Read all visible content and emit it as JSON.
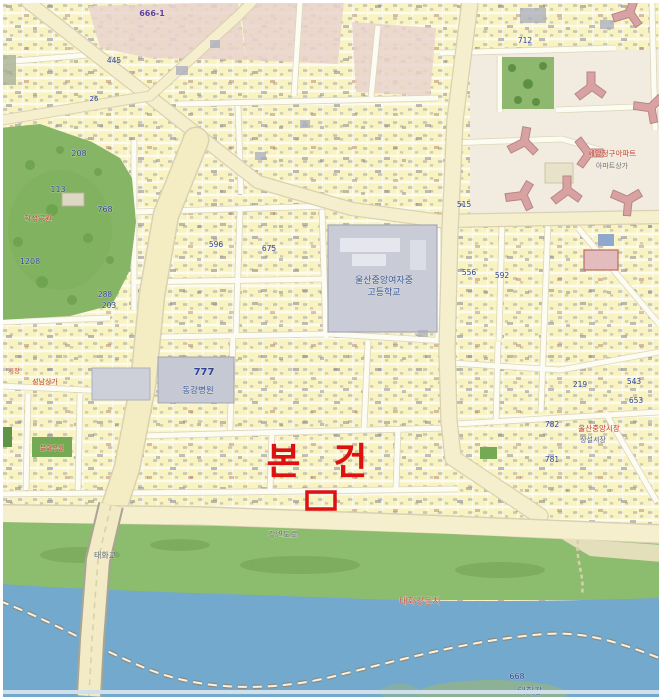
{
  "map": {
    "type": "cadastral-street-map",
    "subject": {
      "label": "본 건",
      "marker_shape": "red-outline-rectangle"
    },
    "colors": {
      "accent_red": "#dd1111",
      "parcel_yellow": "#f8f3c0",
      "road_cream": "#f6efcd",
      "road_white": "#fdfcf3",
      "park_green": "#86b565",
      "bank_green": "#8cbc6d",
      "river_blue": "#72a9cd",
      "apartment_pink": "#d9a2a2",
      "school_gray": "#c9ccd6",
      "commercial_pink": "#e9d4ce"
    },
    "labels": [
      {
        "t": "666-1",
        "x": 152,
        "y": 16,
        "c": "#5b3f9e",
        "s": 8,
        "b": true
      },
      {
        "t": "445",
        "x": 114,
        "y": 63,
        "c": "#2f4396",
        "s": 7.5
      },
      {
        "t": "26",
        "x": 94,
        "y": 101,
        "c": "#2f4396",
        "s": 7
      },
      {
        "t": "712",
        "x": 525,
        "y": 43,
        "c": "#2f4396",
        "s": 7.5
      },
      {
        "t": "208",
        "x": 79,
        "y": 156,
        "c": "#2f4396",
        "s": 8
      },
      {
        "t": "113",
        "x": 58,
        "y": 192,
        "c": "#2f4396",
        "s": 8
      },
      {
        "t": "768",
        "x": 105,
        "y": 212,
        "c": "#2f4396",
        "s": 8
      },
      {
        "t": "학성공원",
        "x": 38,
        "y": 221,
        "c": "#c23b32",
        "s": 7.5
      },
      {
        "t": "1208",
        "x": 30,
        "y": 264,
        "c": "#2f4396",
        "s": 8
      },
      {
        "t": "288",
        "x": 105,
        "y": 297,
        "c": "#2f4396",
        "s": 7.5
      },
      {
        "t": "203",
        "x": 109,
        "y": 308,
        "c": "#2f4396",
        "s": 7.5
      },
      {
        "t": "울산중앙여자중",
        "x": 384,
        "y": 283,
        "c": "#33549e",
        "s": 9
      },
      {
        "t": "고등학교",
        "x": 384,
        "y": 295,
        "c": "#33549e",
        "s": 9
      },
      {
        "t": "세양청구아파트",
        "x": 612,
        "y": 156,
        "c": "#c23b32",
        "s": 7.5
      },
      {
        "t": "아파트상가",
        "x": 612,
        "y": 168,
        "c": "#6b6f78",
        "s": 7
      },
      {
        "t": "596",
        "x": 216,
        "y": 247,
        "c": "#2f4396",
        "s": 7.5
      },
      {
        "t": "675",
        "x": 269,
        "y": 251,
        "c": "#2f4396",
        "s": 7.5
      },
      {
        "t": "515",
        "x": 464,
        "y": 207,
        "c": "#2f4396",
        "s": 7.5
      },
      {
        "t": "556",
        "x": 469,
        "y": 275,
        "c": "#2f4396",
        "s": 7.5
      },
      {
        "t": "592",
        "x": 502,
        "y": 278,
        "c": "#2f4396",
        "s": 7.5
      },
      {
        "t": "777",
        "x": 204,
        "y": 375,
        "c": "#2f4396",
        "s": 10,
        "b": true
      },
      {
        "t": "동강병원",
        "x": 198,
        "y": 393,
        "c": "#33549e",
        "s": 8.5
      },
      {
        "t": "성남상가",
        "x": 45,
        "y": 384,
        "c": "#c23b32",
        "s": 7
      },
      {
        "t": "시장",
        "x": 14,
        "y": 373,
        "c": "#c23b32",
        "s": 6.5
      },
      {
        "t": "219",
        "x": 580,
        "y": 387,
        "c": "#2f4396",
        "s": 7.5
      },
      {
        "t": "543",
        "x": 634,
        "y": 384,
        "c": "#2f4396",
        "s": 7.5
      },
      {
        "t": "653",
        "x": 636,
        "y": 403,
        "c": "#2f4396",
        "s": 7.5
      },
      {
        "t": "울산중앙시장",
        "x": 599,
        "y": 431,
        "c": "#c23b32",
        "s": 7.5
      },
      {
        "t": "상설시장",
        "x": 593,
        "y": 442,
        "c": "#4a5a96",
        "s": 7
      },
      {
        "t": "782",
        "x": 552,
        "y": 427,
        "c": "#2f4396",
        "s": 7.5
      },
      {
        "t": "781",
        "x": 552,
        "y": 462,
        "c": "#2f4396",
        "s": 7.5
      },
      {
        "t": "문화공원",
        "x": 52,
        "y": 450,
        "c": "#c23b32",
        "s": 6.5
      },
      {
        "t": "강변도로",
        "x": 283,
        "y": 537,
        "c": "#6b6f78",
        "s": 8
      },
      {
        "t": "태화교",
        "x": 105,
        "y": 558,
        "c": "#5f6470",
        "s": 8
      },
      {
        "t": "태화강둔치",
        "x": 420,
        "y": 604,
        "c": "#bf5b4b",
        "s": 9
      },
      {
        "t": "668",
        "x": 517,
        "y": 679,
        "c": "#2f4396",
        "s": 8
      },
      {
        "t": "태화강",
        "x": 530,
        "y": 694,
        "c": "#3a5a9c",
        "s": 9
      }
    ]
  }
}
